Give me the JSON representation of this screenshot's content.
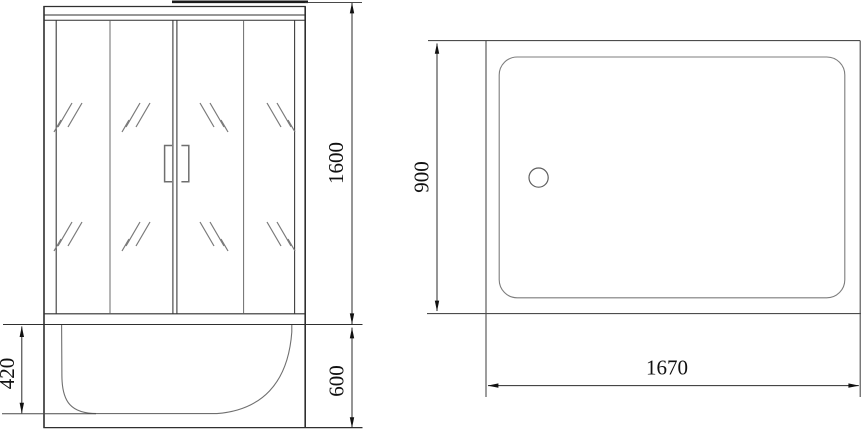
{
  "colors": {
    "background": "#ffffff",
    "outline_dark": "#2f2f2f",
    "line_medium": "#5a5a5a",
    "line_light": "#7d7d7d",
    "dimension_line": "#2b2b2b",
    "text": "#111111"
  },
  "front_view": {
    "dim_door_height": "1600",
    "dim_tray_height": "600",
    "dim_tray_inner_height": "420"
  },
  "top_view": {
    "dim_depth": "900",
    "dim_width": "1670"
  }
}
